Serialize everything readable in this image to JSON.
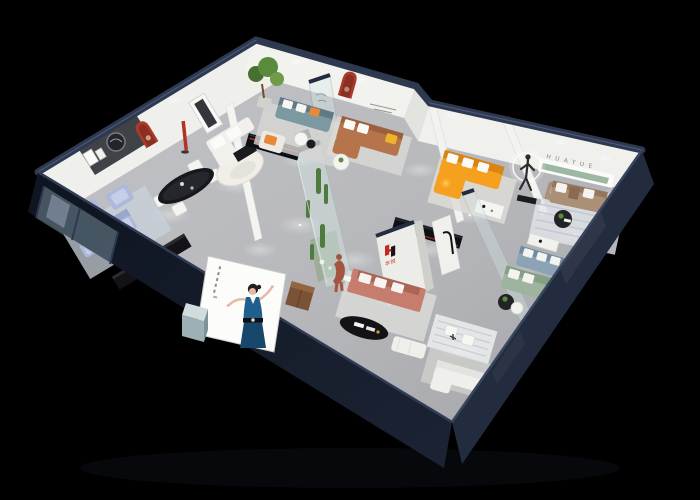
{
  "scene": {
    "title": "3D isometric furniture showroom floor-plan render",
    "background": "#000000",
    "brand": {
      "wall_letters": "HUAYUE",
      "logo_text": "华悦",
      "logo_mark_shape": "H"
    }
  },
  "colors": {
    "building_wall": "#1b2333",
    "building_wall_dark": "#10151f",
    "building_wall_light": "#232c3e",
    "roof_trim": "#2e3950",
    "floor": "#b7b8bb",
    "wall_band": "#efefec",
    "accent_red_arch": "#a93b2c",
    "logo_red": "#c8271e",
    "logo_black": "#17171a",
    "brand_letters_gray": "#8a8a84",
    "shelf_green": "#9db8a2",
    "orange_sofa": "#f5a01f",
    "caramel_sofa": "#b5744a",
    "teal_sofa": "#7c98a0",
    "periwinkle_sofa": "#aeb9da",
    "coral_sofa": "#c77d6d",
    "sage_sofa": "#9eb49e",
    "steelblue_sofa": "#8ba3b5",
    "taupe_sofa": "#ab9078",
    "white_furniture": "#efefeb",
    "black_furniture": "#131317",
    "plant_green": "#4e7b3e",
    "glass": "#d7e9ea",
    "billboard_white": "#fcfcfa",
    "dress_blue": "#1f5f8b",
    "skin": "#e8b9a2",
    "figure_bronze": "#a3553f",
    "halo_white": "#fdfbf2"
  }
}
